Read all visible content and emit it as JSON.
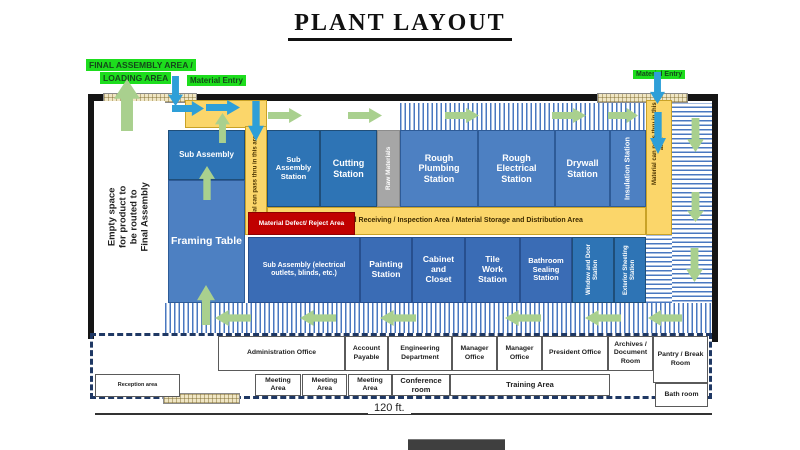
{
  "title": "PLANT LAYOUT",
  "annotations": {
    "final_assembly_area_line1": "FINAL ASSEMBLY AREA /",
    "final_assembly_area_line2": "LOADING AREA",
    "material_entry_left": "Material Entry",
    "material_entry_right": "Material Entry",
    "empty_space_note": "Empty space for product to be routed to Final Assembly",
    "dimension_label": "120 ft."
  },
  "zones": {
    "sub_assembly": "Sub Assembly",
    "framing_table": "Framing Table",
    "pass_thru_left": "Material can pass thru in this area",
    "sub_assembly_station": "Sub Assembly Station",
    "cutting_station": "Cutting Station",
    "raw_materials": "Raw Materials",
    "rough_plumbing_station": "Rough Plumbing Station",
    "rough_electrical_station": "Rough Electrical Station",
    "drywall_station": "Drywall Station",
    "insulation_station": "Insulation Station",
    "pass_thru_right": "Material can pass thru in this area",
    "receiving_area": "Material Receiving / Inspection Area / Material Storage and Distribution Area",
    "defect_area": "Material Defect/ Reject Area",
    "sub_assembly_electrical": "Sub Assembly (electrical outlets, blinds, etc.)",
    "painting_station": "Painting Station",
    "cabinet_closet": "Cabinet and Closet",
    "tile_work_station": "Tile Work Station",
    "bathroom_sealing_station": "Bathroom Sealing Station",
    "window_door_station": "Window and Door Station",
    "exterior_sheeting_station": "Exterior Sheeting Station"
  },
  "offices": {
    "administration": "Administration Office",
    "account_payable": "Account Payable",
    "engineering": "Engineering Department",
    "manager_1": "Manager Office",
    "manager_2": "Manager Office",
    "president": "President Office",
    "archives": "Archives / Document Room",
    "pantry": "Pantry / Break Room",
    "reception": "Reception area",
    "meeting_1": "Meeting Area",
    "meeting_2": "Meeting Area",
    "meeting_3": "Meeting Area",
    "conference": "Conference room",
    "training": "Training Area",
    "bathroom": "Bath room"
  },
  "colors": {
    "station_blue_dark": "#2e74b5",
    "station_blue": "#4d80c2",
    "station_blue_mid": "#3a6cb5",
    "material_yellow": "#fbd66a",
    "reject_red": "#c00000",
    "entry_green": "#1ddd1d",
    "arrow_green": "#a9d08e",
    "arrow_blue": "#2e9fd8",
    "stripe_blue": "#4a78c0",
    "raw_gray": "#a6a6a6"
  }
}
